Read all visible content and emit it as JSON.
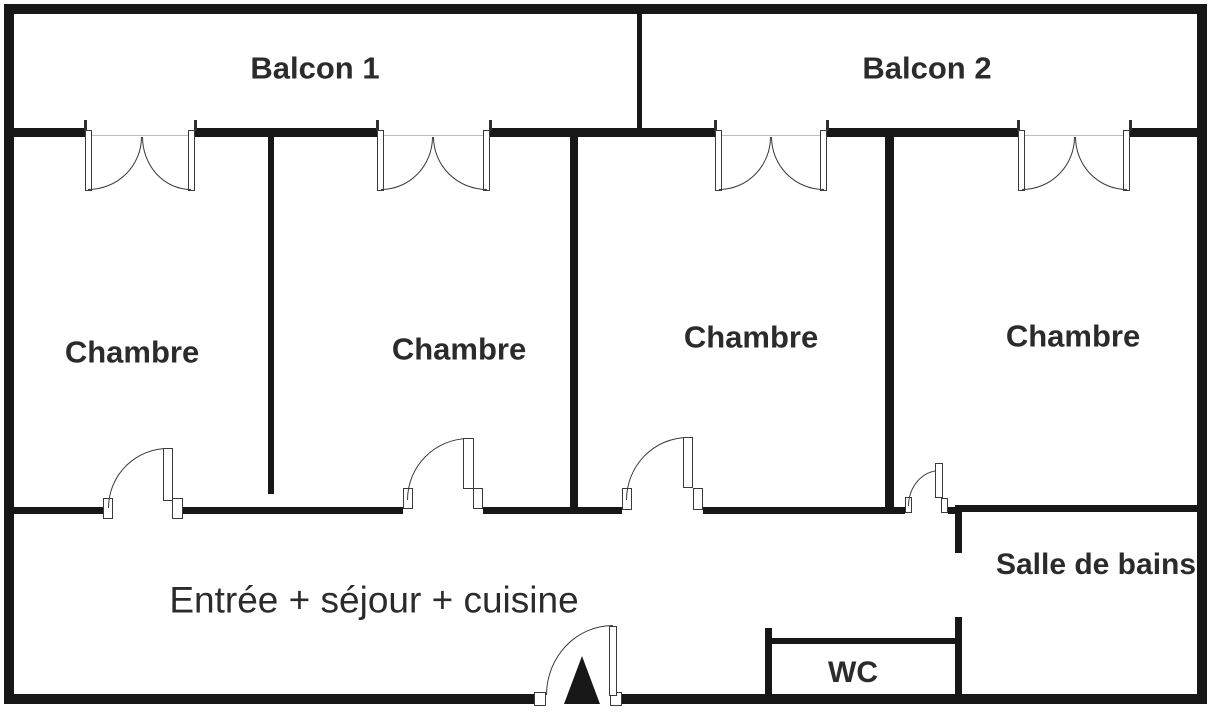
{
  "floorplan": {
    "rooms": {
      "balcon1": {
        "label": "Balcon 1"
      },
      "balcon2": {
        "label": "Balcon 2"
      },
      "chambre1": {
        "label": "Chambre"
      },
      "chambre2": {
        "label": "Chambre"
      },
      "chambre3": {
        "label": "Chambre"
      },
      "chambre4": {
        "label": "Chambre"
      },
      "sejour": {
        "label": "Entrée + séjour + cuisine"
      },
      "salle_de_bains": {
        "label": "Salle de bains"
      },
      "wc": {
        "label": "WC"
      }
    },
    "colors": {
      "wall": "#171717",
      "text": "#2b2b2b",
      "background": "#ffffff",
      "door_outline": "#3a3a3a"
    }
  }
}
